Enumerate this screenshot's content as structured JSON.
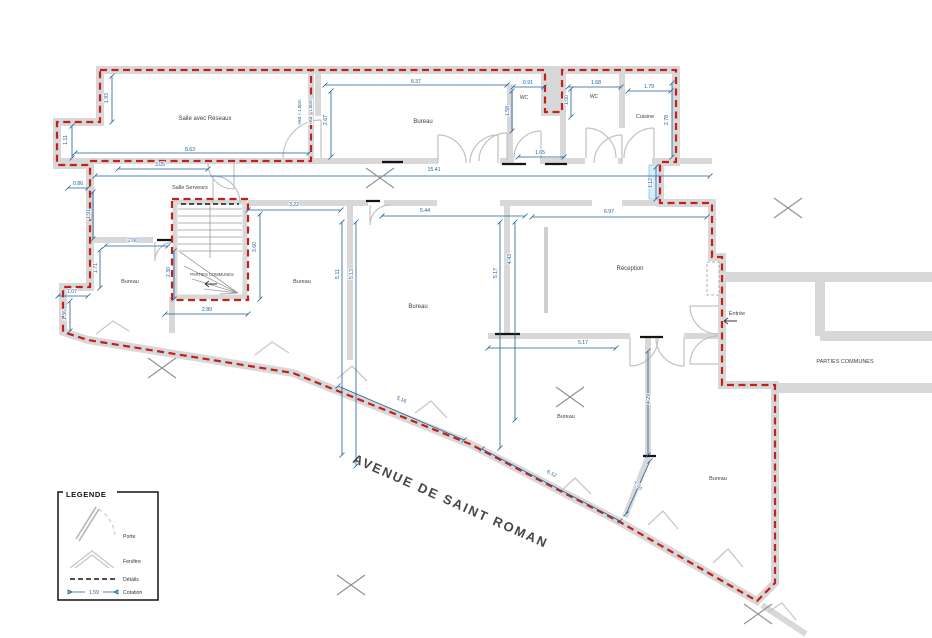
{
  "colors": {
    "boundary_red": "#c2201a",
    "dimension_blue": "#1f5f9f",
    "wall_gray": "#d8d8d8",
    "label_gray": "#3f3f3f"
  },
  "street": {
    "name": "AVENUE DE SAINT ROMAN"
  },
  "legend": {
    "title": "LEGENDE",
    "items": [
      {
        "label": "Porte"
      },
      {
        "label": "Fenêtre"
      },
      {
        "label": "Détails"
      },
      {
        "label": "Cotation",
        "sample_value": "1.59"
      }
    ]
  },
  "rooms": [
    {
      "name": "Salle  avec Réseaux",
      "x": 205,
      "y": 120,
      "s": 6
    },
    {
      "name": "Salle Serveurs",
      "x": 190,
      "y": 189,
      "s": 5.5
    },
    {
      "name": "Bureau",
      "x": 423,
      "y": 123,
      "s": 6
    },
    {
      "name": "WC",
      "x": 524,
      "y": 99,
      "s": 5
    },
    {
      "name": "WC",
      "x": 594,
      "y": 98,
      "s": 5
    },
    {
      "name": "Cuisine",
      "x": 645,
      "y": 118,
      "s": 5.5
    },
    {
      "name": "Bureau",
      "x": 130,
      "y": 283,
      "s": 5.5
    },
    {
      "name": "PARTIES COMMUNES",
      "x": 212,
      "y": 276,
      "s": 4.2
    },
    {
      "name": "Bureau",
      "x": 302,
      "y": 283,
      "s": 5.5
    },
    {
      "name": "Bureau",
      "x": 418,
      "y": 308,
      "s": 6
    },
    {
      "name": "Réception",
      "x": 630,
      "y": 270,
      "s": 6
    },
    {
      "name": "Entrée",
      "x": 737,
      "y": 315,
      "s": 5.5
    },
    {
      "name": "PARTIES COMMUNES",
      "x": 845,
      "y": 363,
      "s": 5.5
    },
    {
      "name": "Bureau",
      "x": 566,
      "y": 418,
      "s": 5.5
    },
    {
      "name": "Bureau",
      "x": 718,
      "y": 480,
      "s": 5.5
    }
  ],
  "dimensions": [
    {
      "v": "1.93",
      "x": 108,
      "y": 98,
      "r": -90
    },
    {
      "v": "1.11",
      "x": 67,
      "y": 140,
      "r": -90
    },
    {
      "v": "8.63",
      "x": 190,
      "y": 151,
      "r": 0
    },
    {
      "v": "Hsd < 1.80m",
      "x": 301,
      "y": 112,
      "r": -90,
      "s": 4.4
    },
    {
      "v": "Hsd > 1.80m",
      "x": 312,
      "y": 112,
      "r": -90,
      "s": 4.4
    },
    {
      "v": "2.67",
      "x": 327,
      "y": 120,
      "r": -90
    },
    {
      "v": "6.37",
      "x": 416,
      "y": 83,
      "r": 0
    },
    {
      "v": "0.91",
      "x": 528,
      "y": 84,
      "r": 0
    },
    {
      "v": "1.58",
      "x": 509,
      "y": 111,
      "r": -90
    },
    {
      "v": "1.68",
      "x": 596,
      "y": 84,
      "r": 0
    },
    {
      "v": "1.00",
      "x": 568,
      "y": 100,
      "r": -90
    },
    {
      "v": "1.79",
      "x": 649,
      "y": 88,
      "r": 0
    },
    {
      "v": "2.78",
      "x": 668,
      "y": 120,
      "r": -90
    },
    {
      "v": "1.65",
      "x": 540,
      "y": 154,
      "r": 0
    },
    {
      "v": "1.12",
      "x": 652,
      "y": 183,
      "r": -90
    },
    {
      "v": "3.05",
      "x": 160,
      "y": 166,
      "r": 0
    },
    {
      "v": "15.41",
      "x": 434,
      "y": 171,
      "r": 0
    },
    {
      "v": "0.86",
      "x": 78,
      "y": 185,
      "r": 0
    },
    {
      "v": "1.91",
      "x": 90,
      "y": 214,
      "r": -90
    },
    {
      "v": "2.60",
      "x": 133,
      "y": 242,
      "r": 0
    },
    {
      "v": "1.71",
      "x": 97,
      "y": 268,
      "r": -90
    },
    {
      "v": "1.07",
      "x": 72,
      "y": 293,
      "r": 0
    },
    {
      "v": "1.36",
      "x": 66,
      "y": 315,
      "r": -90
    },
    {
      "v": "2.30",
      "x": 170,
      "y": 272,
      "r": -90
    },
    {
      "v": "3.60",
      "x": 256,
      "y": 247,
      "r": -90
    },
    {
      "v": "2.89",
      "x": 207,
      "y": 311,
      "r": 0
    },
    {
      "v": "3.22",
      "x": 294,
      "y": 206,
      "r": 0
    },
    {
      "v": "5.11",
      "x": 339,
      "y": 274,
      "r": -90
    },
    {
      "v": "5.13",
      "x": 353,
      "y": 274,
      "r": -90
    },
    {
      "v": "5.44",
      "x": 425,
      "y": 212,
      "r": 0
    },
    {
      "v": "5.17",
      "x": 497,
      "y": 273,
      "r": -90
    },
    {
      "v": "4.43",
      "x": 511,
      "y": 259,
      "r": -90
    },
    {
      "v": "6.97",
      "x": 609,
      "y": 213,
      "r": 0
    },
    {
      "v": "5.17",
      "x": 583,
      "y": 344,
      "r": 0
    },
    {
      "v": "4.29",
      "x": 650,
      "y": 399,
      "r": -90
    },
    {
      "v": "5.16",
      "x": 401,
      "y": 401,
      "r": 24
    },
    {
      "v": "6.12",
      "x": 551,
      "y": 475,
      "r": 28
    },
    {
      "v": "2.50",
      "x": 637,
      "y": 486,
      "r": 62
    }
  ]
}
